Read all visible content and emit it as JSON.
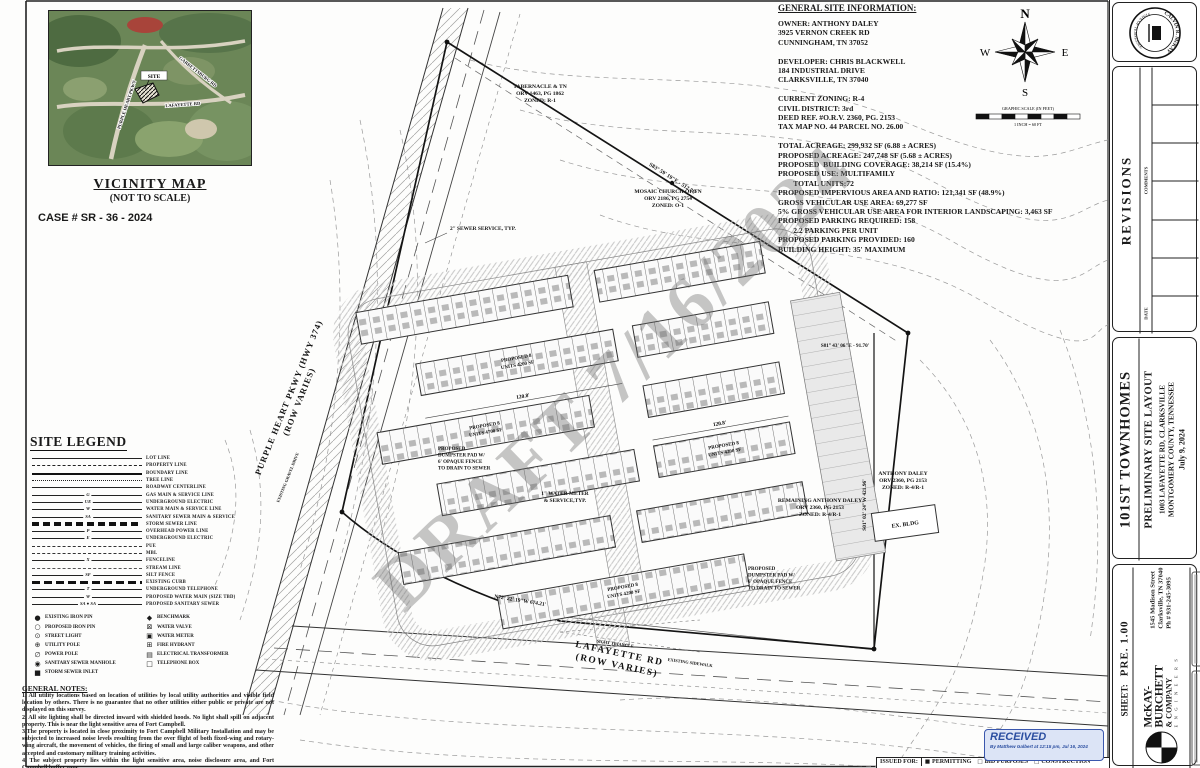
{
  "vicinity": {
    "title": "VICINITY MAP",
    "subtitle": "(NOT TO SCALE)",
    "case_number": "CASE # SR - 36 - 2024",
    "map_labels": {
      "site": "SITE",
      "purple_heart": "PURPLE HEART PKWY",
      "garrettsburg": "GARRETTSBURG RD",
      "lafayette": "LAFAYETTE RD"
    }
  },
  "site_info": {
    "heading": "GENERAL SITE INFORMATION:",
    "lines": [
      "OWNER: ANTHONY DALEY",
      "3925 VERNON CREEK RD",
      "CUNNINGHAM, TN 37052",
      "",
      "DEVELOPER: CHRIS BLACKWELL",
      "184 INDUSTRIAL DRIVE",
      "CLARKSVILLE, TN 37040",
      "",
      "CURRENT ZONING: R-4",
      "CIVIL DISTRICT: 3rd",
      "DEED REF. #O.R.V. 2360, PG. 2153",
      "TAX MAP NO. 44 PARCEL NO. 26.00",
      "",
      "TOTAL ACREAGE: 299,932 SF (6.88 ± ACRES)",
      "PROPOSED ACREAGE: 247,748 SF (5.68 ± ACRES)",
      "PROPOSED  BUILDING COVERAGE: 38,214 SF (15.4%)",
      "PROPOSED USE: MULTIFAMILY",
      "        TOTAL UNITS:72",
      "PROPOSED IMPERVIOUS AREA AND RATIO: 121,341 SF (48.9%)",
      "GROSS VEHICULAR USE AREA: 69,277 SF",
      "5% GROSS VEHICULAR USE AREA FOR INTERIOR LANDSCAPING: 3,463 SF",
      "PROPOSED PARKING REQUIRED: 158",
      "        2.2 PARKING PER UNIT",
      "PROPOSED PARKING PROVIDED: 160",
      "BUILDING HEIGHT: 35' MAXIMUM"
    ]
  },
  "compass": {
    "n": "N",
    "e": "E",
    "s": "S",
    "w": "W"
  },
  "scale_bar": {
    "caption": "GRAPHIC SCALE (IN FEET)",
    "sub": "1 INCH = 60 FT"
  },
  "legend": {
    "title": "SITE LEGEND",
    "line_items": [
      {
        "label": "LOT LINE"
      },
      {
        "label": "PROPERTY LINE",
        "style": "dashdot"
      },
      {
        "label": "BOUNDARY LINE",
        "style": "thick"
      },
      {
        "label": "TREE LINE",
        "style": "scallop"
      },
      {
        "label": "ROADWAY CENTERLINE",
        "style": "center"
      },
      {
        "label": "GAS MAIN & SERVICE LINE",
        "sym": "G"
      },
      {
        "label": "UNDERGROUND ELECTRIC",
        "sym": "UE"
      },
      {
        "label": "WATER MAIN & SERVICE LINE",
        "sym": "W"
      },
      {
        "label": "SANITARY SEWER MAIN & SERVICE",
        "sym": "SA"
      },
      {
        "label": "STORM SEWER LINE",
        "style": "squares"
      },
      {
        "label": "OVERHEAD POWER LINE",
        "sym": "P"
      },
      {
        "label": "UNDERGROUND ELECTRIC",
        "sym": "E"
      },
      {
        "label": "PUE",
        "style": "dash"
      },
      {
        "label": "MBL",
        "style": "dash"
      },
      {
        "label": "FENCELINE",
        "sym": "X"
      },
      {
        "label": "STREAM LINE",
        "style": "dashlong"
      },
      {
        "label": "SILT FENCE",
        "sym": "SF"
      },
      {
        "label": "EXISTING CURB",
        "style": "squares2"
      },
      {
        "label": "UNDERGROUND TELEPHONE",
        "sym": "T"
      },
      {
        "label": "PROPOSED WATER MAIN (SIZE TBD)",
        "sym": "W"
      },
      {
        "label": "PROPOSED SANITARY SEWER",
        "style": "sansewer",
        "sym": "SA ● SA"
      }
    ],
    "symbols_left": [
      {
        "glyph": "●",
        "label": "EXISTING IRON PIN"
      },
      {
        "glyph": "○",
        "label": "PROPOSED IRON PIN"
      },
      {
        "glyph": "⊙",
        "label": "STREET LIGHT"
      },
      {
        "glyph": "⊕",
        "label": "UTILITY POLE"
      },
      {
        "glyph": "∅",
        "label": "POWER POLE"
      },
      {
        "glyph": "◉",
        "label": "SANITARY SEWER MANHOLE"
      },
      {
        "glyph": "■",
        "label": "STORM SEWER INLET"
      }
    ],
    "symbols_right": [
      {
        "glyph": "◆",
        "label": "BENCHMARK"
      },
      {
        "glyph": "⊠",
        "label": "WATER VALVE"
      },
      {
        "glyph": "▣",
        "label": "WATER METER"
      },
      {
        "glyph": "⊞",
        "label": "FIRE HYDRANT"
      },
      {
        "glyph": "▤",
        "label": "ELECTRICAL TRANSFORMER"
      },
      {
        "glyph": "□",
        "label": "TELEPHONE BOX"
      }
    ]
  },
  "general_notes": {
    "heading": "GENERAL NOTES:",
    "notes": [
      "1. All utility locations based on location of utilities by local utility authorities and visible field location by others. There is no guarantee that  no other utilities either public or private are not displayed on this survey.",
      "2. All site lighting shall be directed inward with shielded hoods. No light shall spill on adjacent property. This is near the light sensitive area of Fort Campbell.",
      "3.The property is located in close proximity to Fort Campbell Military Installation and may be subjected to increased noise levels resulting from the over flight of both fixed-wing and rotary-wing aircraft, the movement of vehicles, the firing of small and large caliber weapons, and other accepted and customary military training activities.",
      "4. The subject property lies within the light sensitive area, noise disclosure area, and Fort Campbell buffer zone."
    ]
  },
  "plan": {
    "watermark": "DRAFT 7/16/2024",
    "roads": {
      "purple_heart_1": "PURPLE HEART PKWY (HWY 374)",
      "purple_heart_2": "(ROW VARIES)",
      "lafayette_1": "LAFAYETTE RD",
      "lafayette_2": "(ROW VARIES)",
      "sight_triangle": "SIGHT TRIANGLE",
      "existing_sidewalk": "EXISTING SIDEWALK",
      "existing_gravel": "EXISTING GRAVEL DRIVE"
    },
    "parcels": {
      "tabernacle": [
        "TABERNACLE & TN",
        "ORV 1463, PG 1862",
        "ZONED: R-1"
      ],
      "mosaic": [
        "MOSAIC CHURCH OF TN",
        "ORV 2186, PG 2754",
        "ZONED: O-1"
      ],
      "anthony": [
        "ANTHONY DALEY",
        "ORV 2360, PG 2153",
        "ZONED: R-4/R-1"
      ],
      "remaining": [
        "REMAINING ANTHONY DALEY",
        "ORV 2360, PG 2153",
        "ZONED: R-4/R-1"
      ],
      "ex_bldg": "EX. BLDG"
    },
    "bearings": {
      "north": "S83° 59' 19\"E - 512.76'",
      "northeast": "S81° 43' 06\"E - 91.70'",
      "east": "S01° 02' 24\"W  421.96'",
      "south": "N72° 22' 19\"W  674.21'"
    },
    "callouts": {
      "sewer_service": "2\" SEWER SERVICE, TYP.",
      "water_meter": [
        "1\" WATER METER",
        "& SERVICE,TYP."
      ],
      "dumpster": [
        "PROPOSED",
        "DUMPSTER PAD W/",
        "6' OPAQUE FENCE",
        "TO DRAIN TO SEWER"
      ],
      "building_a": [
        "PROPOSED 8",
        "UNITS 4200 SF"
      ],
      "building_b": [
        "PROPOSED 8",
        "UNITS 4700 SF"
      ],
      "dim": "120.8'"
    }
  },
  "received_stamp": {
    "title": "RECEIVED",
    "sub": "By Matthew Galbert at 12:15 pm, Jul 16, 2024"
  },
  "issued_for": {
    "label": "ISSUED FOR:",
    "items": [
      {
        "box": "■",
        "label": "PERMITTING"
      },
      {
        "box": "□",
        "label": "BID PURPOSES"
      },
      {
        "box": "□",
        "label": "CONSTRUCTION"
      }
    ]
  },
  "title_block": {
    "seal_name": "CALVIN R. McKAY",
    "seal_sub": "STATE OF TENNESSEE",
    "revisions": {
      "title": "REVISIONS",
      "comments": "COMMENTS",
      "date": "DATE"
    },
    "project": "101ST TOWNHOMES",
    "sheet_title": "PRELIMINARY SITE LAYOUT",
    "address1": "1003 LAFAYETTE RD, CLARKSVILLE",
    "address2": "MONTGOMERY COUNTY, TENNESSEE",
    "date": "July 9, 2024",
    "firm": "McKAY-BURCHETT",
    "firm2": "& COMPANY",
    "firm3": "E N G I N E E R S",
    "firm_addr1": "1545 Madison Street",
    "firm_addr2": "Clarksville, TN 37040",
    "firm_phone": "Ph # 931-245-3095",
    "sheet_label": "SHEET:",
    "sheet_number": "PRE. 1.00"
  }
}
